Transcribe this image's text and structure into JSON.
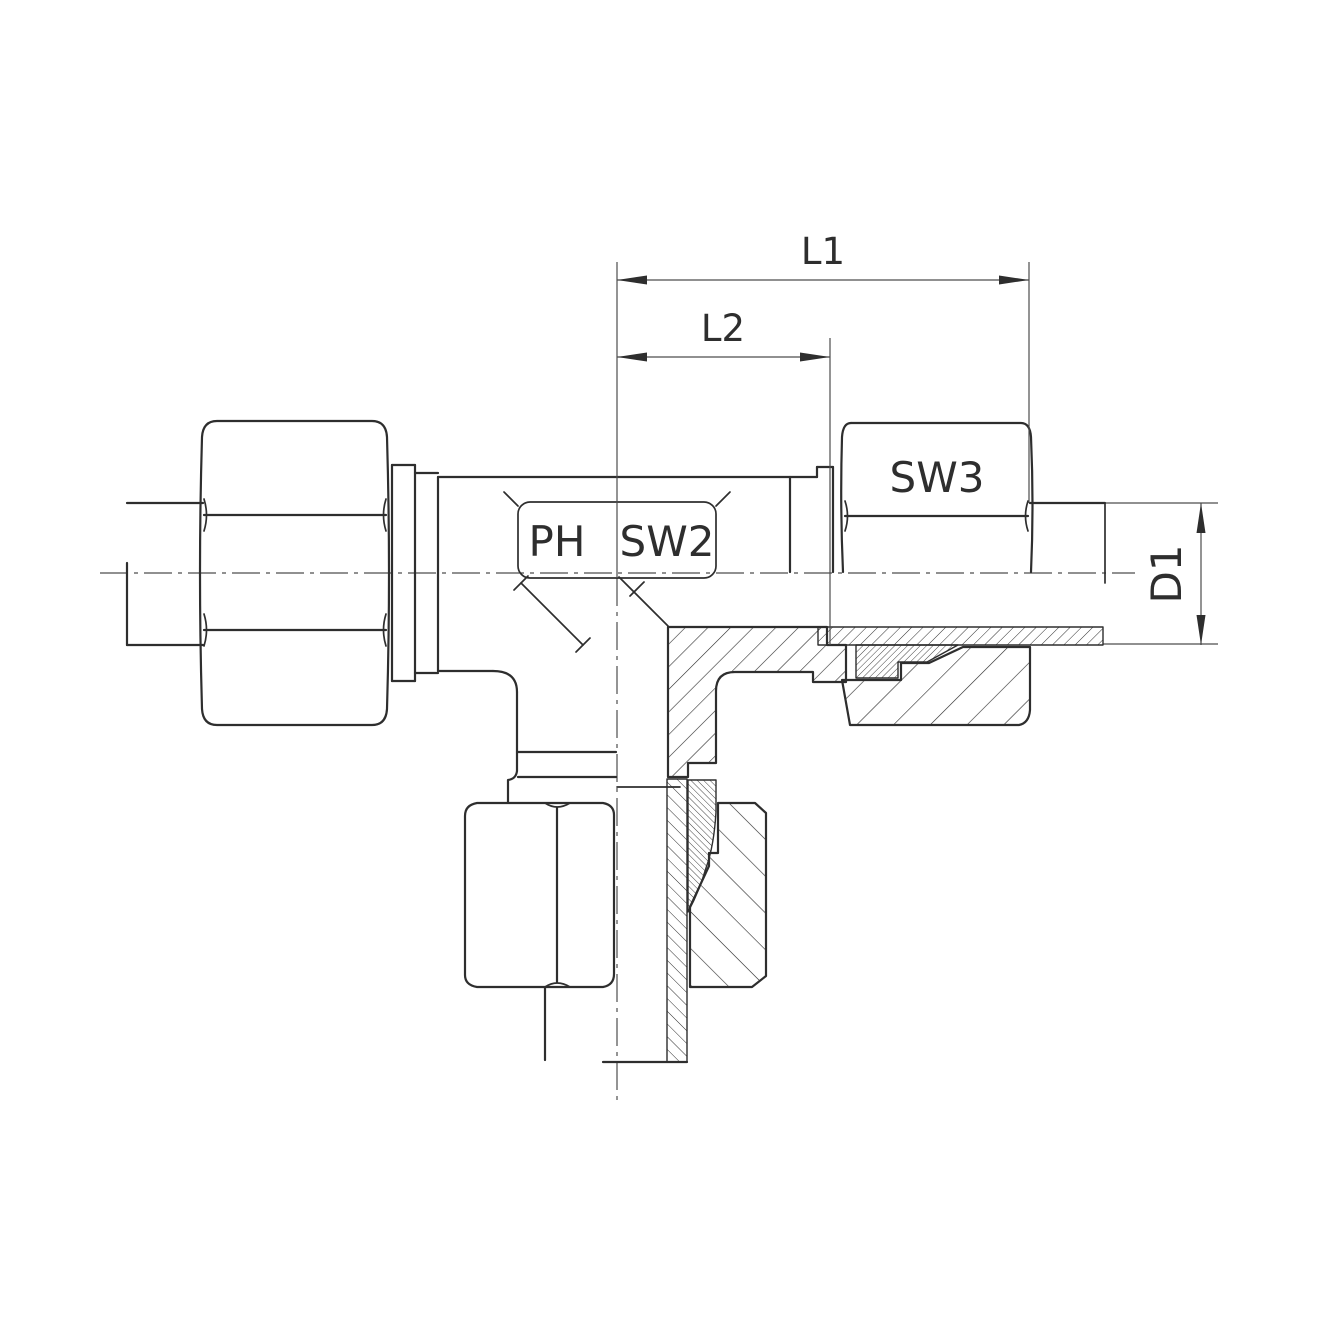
{
  "drawing": {
    "kind": "technical-drawing-tee-fitting-cross-section",
    "labels": {
      "l1": "L1",
      "l2": "L2",
      "ph": "PH",
      "sw2": "SW2",
      "sw3": "SW3",
      "d1": "D1"
    },
    "colors": {
      "line": "#2e2e2e",
      "centerline": "#4d4d4d",
      "background": "#ffffff"
    }
  }
}
